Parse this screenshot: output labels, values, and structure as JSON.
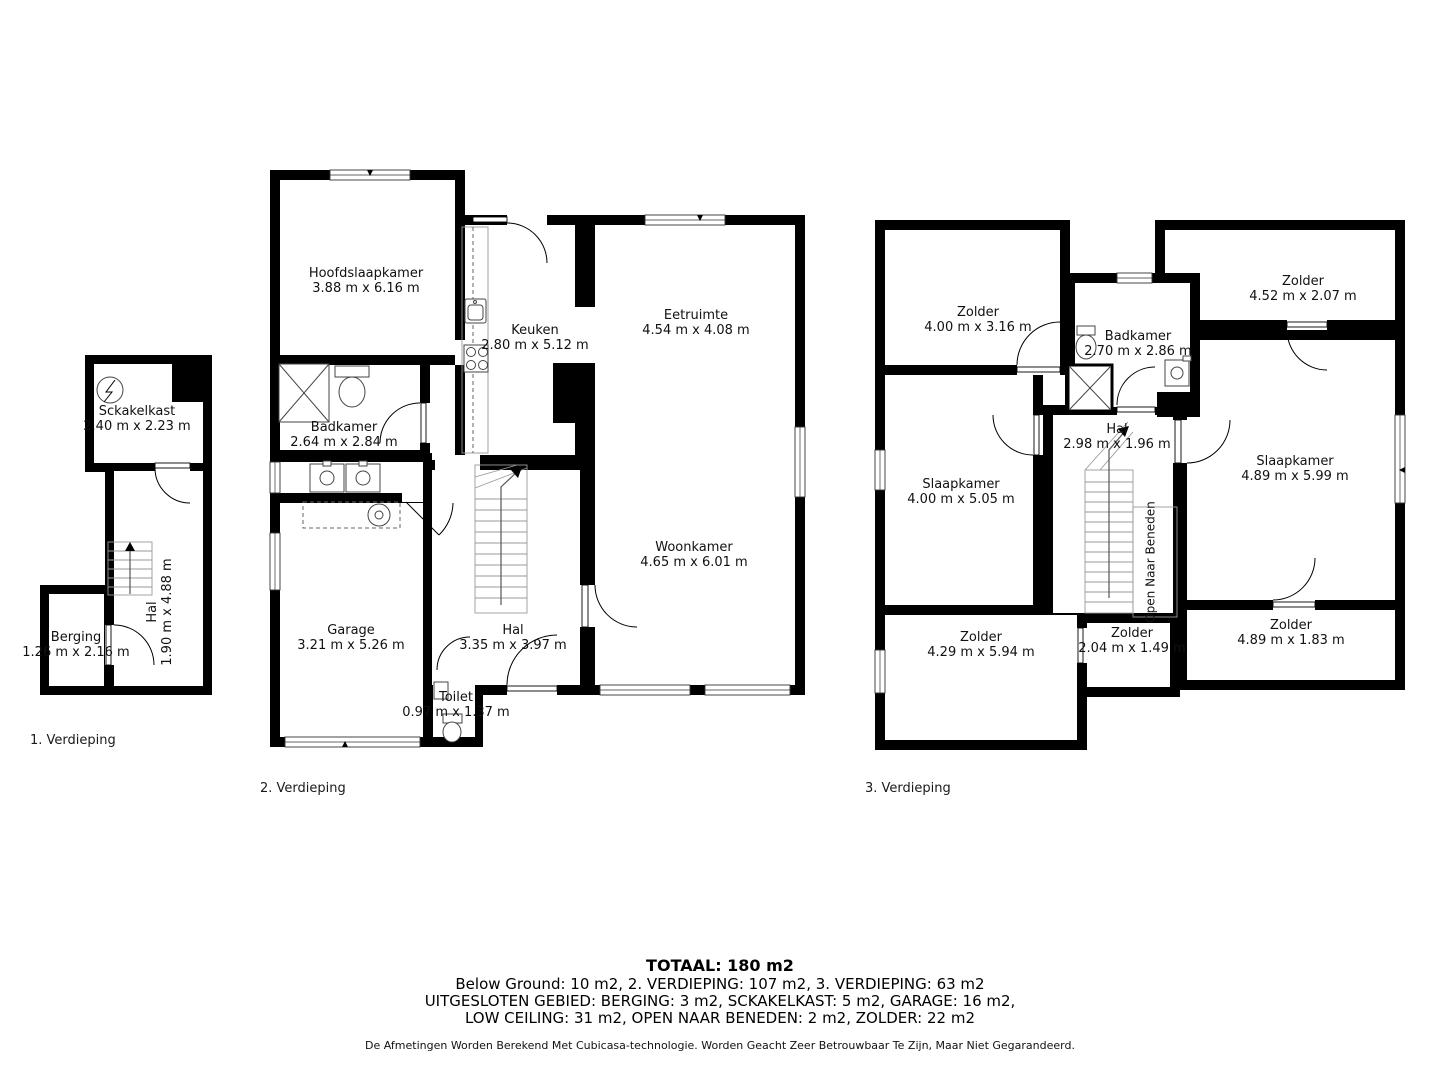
{
  "floors": [
    {
      "label": "1. Verdieping",
      "rooms": [
        {
          "name": "Sckakelkast",
          "dims": "2.40 m x 2.23 m"
        },
        {
          "name": "Hal",
          "dims": "1.90 m x 4.88 m"
        },
        {
          "name": "Berging",
          "dims": "1.26 m x 2.16 m"
        }
      ]
    },
    {
      "label": "2. Verdieping",
      "rooms": [
        {
          "name": "Hoofdslaapkamer",
          "dims": "3.88 m x 6.16 m"
        },
        {
          "name": "Keuken",
          "dims": "2.80 m x 5.12 m"
        },
        {
          "name": "Eetruimte",
          "dims": "4.54 m x 4.08 m"
        },
        {
          "name": "Badkamer",
          "dims": "2.64 m x 2.84 m"
        },
        {
          "name": "Garage",
          "dims": "3.21 m x 5.26 m"
        },
        {
          "name": "Hal",
          "dims": "3.35 m x 3.97 m"
        },
        {
          "name": "Toilet",
          "dims": "0.97 m x 1.37 m"
        },
        {
          "name": "Woonkamer",
          "dims": "4.65 m x 6.01 m"
        }
      ]
    },
    {
      "label": "3. Verdieping",
      "rooms": [
        {
          "name": "Zolder",
          "dims": "4.00 m x 3.16 m"
        },
        {
          "name": "Badkamer",
          "dims": "2.70 m x 2.86 m"
        },
        {
          "name": "Zolder",
          "dims": "4.52 m x 2.07 m"
        },
        {
          "name": "Slaapkamer",
          "dims": "4.00 m x 5.05 m"
        },
        {
          "name": "Hal",
          "dims": "2.98 m x 1.96 m"
        },
        {
          "name": "Slaapkamer",
          "dims": "4.89 m x 5.99 m"
        },
        {
          "name": "Zolder",
          "dims": "4.29 m x 5.94 m"
        },
        {
          "name": "Zolder",
          "dims": "2.04 m x 1.49 m"
        },
        {
          "name": "Zolder",
          "dims": "4.89 m x 1.83 m"
        },
        {
          "name": "Open Naar Beneden",
          "dims": ""
        }
      ]
    }
  ],
  "summary": {
    "total": "TOTAAL: 180 m2",
    "line1": "Below Ground: 10 m2, 2. VERDIEPING: 107 m2, 3. VERDIEPING: 63 m2",
    "line2": "UITGESLOTEN GEBIED: BERGING: 3 m2, SCKAKELKAST: 5 m2, GARAGE: 16 m2,",
    "line3": "LOW CEILING: 31 m2, OPEN NAAR BENEDEN: 2 m2, ZOLDER: 22 m2",
    "disclaimer": "De Afmetingen Worden Berekend Met Cubicasa-technologie. Worden Geacht Zeer Betrouwbaar Te Zijn, Maar Niet Gegarandeerd."
  },
  "colors": {
    "wall": "#000000",
    "floor": "#ffffff",
    "background": "#ffffff"
  }
}
